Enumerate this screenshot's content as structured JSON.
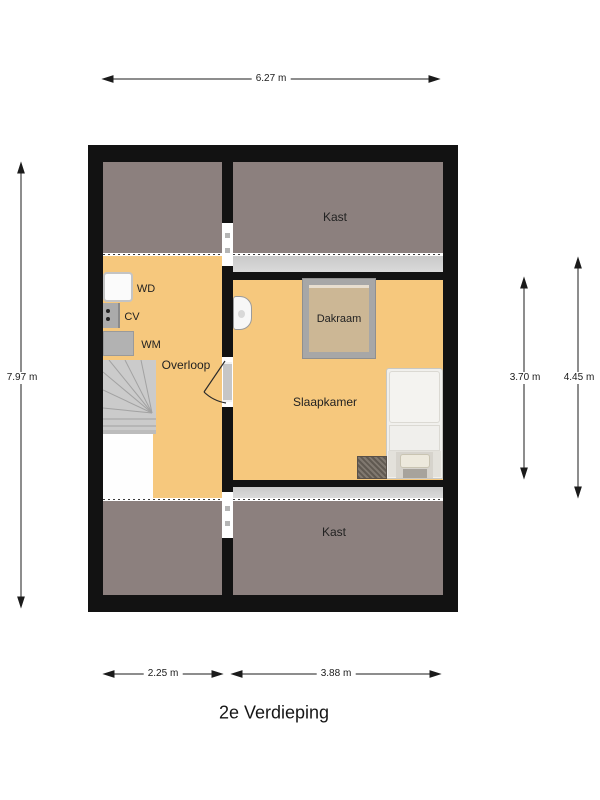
{
  "title": "2e Verdieping",
  "dimensions": {
    "top": "6.27 m",
    "left": "7.97 m",
    "right_inner": "3.70 m",
    "right_outer": "4.45 m",
    "bottom_left": "2.25 m",
    "bottom_right": "3.88 m"
  },
  "rooms": {
    "kast_top": "Kast",
    "kast_bottom": "Kast",
    "overloop": "Overloop",
    "slaapkamer": "Slaapkamer",
    "dakraam": "Dakraam"
  },
  "appliances": {
    "wd": "WD",
    "cv": "CV",
    "wm": "WM"
  },
  "colors": {
    "wall": "#121212",
    "floor_orange": "#f6c87d",
    "storage_gray": "#8c807e",
    "threshold_band": "#d3d3d3",
    "skylight_fill": "#ccb795",
    "skylight_frame": "#a7a7a7"
  }
}
